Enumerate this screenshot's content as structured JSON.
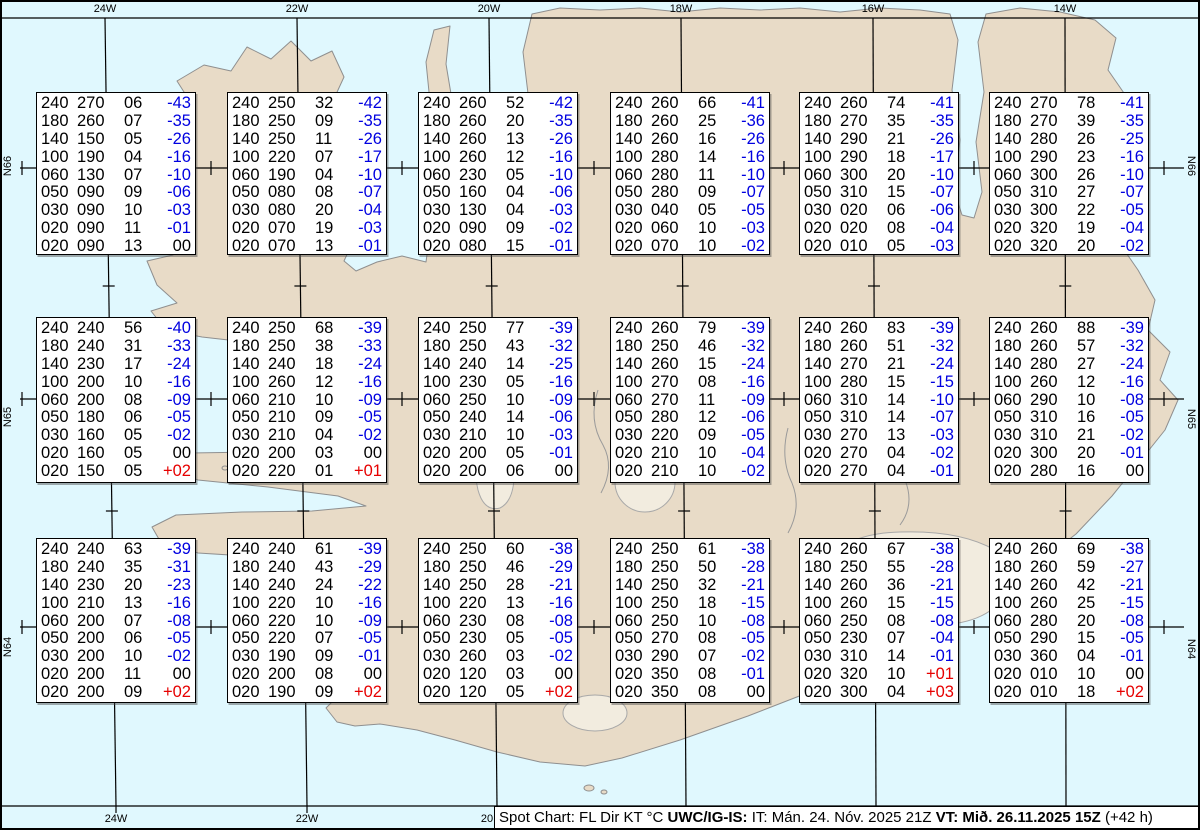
{
  "colors": {
    "water": "#e0f8fe",
    "land": "#e8dbc7",
    "coastline": "#8f8f8f",
    "temp_negative": "#0000e0",
    "temp_positive": "#e60000",
    "table_background": "#ffffff",
    "graticule": "#000000"
  },
  "graticule": {
    "top_labels": [
      "24W",
      "22W",
      "20W",
      "18W",
      "16W",
      "14W"
    ],
    "bottom_labels": [
      "24W",
      "22W",
      "20"
    ],
    "left_labels": [
      "N66",
      "N65",
      "N64"
    ],
    "right_labels": [
      "N66",
      "N65",
      "N64"
    ]
  },
  "boxes": [
    {
      "rows": [
        [
          "240",
          "270",
          "06",
          "-43"
        ],
        [
          "180",
          "260",
          "07",
          "-35"
        ],
        [
          "140",
          "150",
          "05",
          "-26"
        ],
        [
          "100",
          "190",
          "04",
          "-16"
        ],
        [
          "060",
          "130",
          "07",
          "-10"
        ],
        [
          "050",
          "090",
          "09",
          "-06"
        ],
        [
          "030",
          "090",
          "10",
          "-03"
        ],
        [
          "020",
          "090",
          "11",
          "-01"
        ],
        [
          "020",
          "090",
          "13",
          "00"
        ]
      ]
    },
    {
      "rows": [
        [
          "240",
          "250",
          "32",
          "-42"
        ],
        [
          "180",
          "250",
          "09",
          "-35"
        ],
        [
          "140",
          "250",
          "11",
          "-26"
        ],
        [
          "100",
          "220",
          "07",
          "-17"
        ],
        [
          "060",
          "190",
          "04",
          "-10"
        ],
        [
          "050",
          "080",
          "08",
          "-07"
        ],
        [
          "030",
          "080",
          "20",
          "-04"
        ],
        [
          "020",
          "070",
          "19",
          "-03"
        ],
        [
          "020",
          "070",
          "13",
          "-01"
        ]
      ]
    },
    {
      "rows": [
        [
          "240",
          "260",
          "52",
          "-42"
        ],
        [
          "180",
          "260",
          "20",
          "-35"
        ],
        [
          "140",
          "260",
          "13",
          "-26"
        ],
        [
          "100",
          "260",
          "12",
          "-16"
        ],
        [
          "060",
          "230",
          "05",
          "-10"
        ],
        [
          "050",
          "160",
          "04",
          "-06"
        ],
        [
          "030",
          "130",
          "04",
          "-03"
        ],
        [
          "020",
          "090",
          "09",
          "-02"
        ],
        [
          "020",
          "080",
          "15",
          "-01"
        ]
      ]
    },
    {
      "rows": [
        [
          "240",
          "260",
          "66",
          "-41"
        ],
        [
          "180",
          "260",
          "25",
          "-36"
        ],
        [
          "140",
          "260",
          "16",
          "-26"
        ],
        [
          "100",
          "280",
          "14",
          "-16"
        ],
        [
          "060",
          "280",
          "11",
          "-10"
        ],
        [
          "050",
          "280",
          "09",
          "-07"
        ],
        [
          "030",
          "040",
          "05",
          "-05"
        ],
        [
          "020",
          "060",
          "10",
          "-03"
        ],
        [
          "020",
          "070",
          "10",
          "-02"
        ]
      ]
    },
    {
      "rows": [
        [
          "240",
          "260",
          "74",
          "-41"
        ],
        [
          "180",
          "270",
          "35",
          "-35"
        ],
        [
          "140",
          "290",
          "21",
          "-26"
        ],
        [
          "100",
          "290",
          "18",
          "-17"
        ],
        [
          "060",
          "300",
          "20",
          "-10"
        ],
        [
          "050",
          "310",
          "15",
          "-07"
        ],
        [
          "030",
          "020",
          "06",
          "-06"
        ],
        [
          "020",
          "020",
          "08",
          "-04"
        ],
        [
          "020",
          "010",
          "05",
          "-03"
        ]
      ]
    },
    {
      "rows": [
        [
          "240",
          "270",
          "78",
          "-41"
        ],
        [
          "180",
          "270",
          "39",
          "-35"
        ],
        [
          "140",
          "280",
          "26",
          "-25"
        ],
        [
          "100",
          "290",
          "23",
          "-16"
        ],
        [
          "060",
          "300",
          "26",
          "-10"
        ],
        [
          "050",
          "310",
          "27",
          "-07"
        ],
        [
          "030",
          "300",
          "22",
          "-05"
        ],
        [
          "020",
          "320",
          "19",
          "-04"
        ],
        [
          "020",
          "320",
          "20",
          "-02"
        ]
      ]
    },
    {
      "rows": [
        [
          "240",
          "240",
          "56",
          "-40"
        ],
        [
          "180",
          "240",
          "31",
          "-33"
        ],
        [
          "140",
          "230",
          "17",
          "-24"
        ],
        [
          "100",
          "200",
          "10",
          "-16"
        ],
        [
          "060",
          "200",
          "08",
          "-09"
        ],
        [
          "050",
          "180",
          "06",
          "-05"
        ],
        [
          "030",
          "160",
          "05",
          "-02"
        ],
        [
          "020",
          "160",
          "05",
          "00"
        ],
        [
          "020",
          "150",
          "05",
          "+02"
        ]
      ]
    },
    {
      "rows": [
        [
          "240",
          "250",
          "68",
          "-39"
        ],
        [
          "180",
          "250",
          "38",
          "-33"
        ],
        [
          "140",
          "240",
          "18",
          "-24"
        ],
        [
          "100",
          "260",
          "12",
          "-16"
        ],
        [
          "060",
          "210",
          "10",
          "-09"
        ],
        [
          "050",
          "210",
          "09",
          "-05"
        ],
        [
          "030",
          "210",
          "04",
          "-02"
        ],
        [
          "020",
          "200",
          "03",
          "00"
        ],
        [
          "020",
          "220",
          "01",
          "+01"
        ]
      ]
    },
    {
      "rows": [
        [
          "240",
          "250",
          "77",
          "-39"
        ],
        [
          "180",
          "250",
          "43",
          "-32"
        ],
        [
          "140",
          "240",
          "14",
          "-25"
        ],
        [
          "100",
          "230",
          "05",
          "-16"
        ],
        [
          "060",
          "250",
          "10",
          "-09"
        ],
        [
          "050",
          "240",
          "14",
          "-06"
        ],
        [
          "030",
          "210",
          "10",
          "-03"
        ],
        [
          "020",
          "200",
          "05",
          "-01"
        ],
        [
          "020",
          "200",
          "06",
          "00"
        ]
      ]
    },
    {
      "rows": [
        [
          "240",
          "260",
          "79",
          "-39"
        ],
        [
          "180",
          "250",
          "46",
          "-32"
        ],
        [
          "140",
          "260",
          "15",
          "-24"
        ],
        [
          "100",
          "270",
          "08",
          "-16"
        ],
        [
          "060",
          "270",
          "11",
          "-09"
        ],
        [
          "050",
          "280",
          "12",
          "-06"
        ],
        [
          "030",
          "220",
          "09",
          "-05"
        ],
        [
          "020",
          "210",
          "10",
          "-04"
        ],
        [
          "020",
          "210",
          "10",
          "-02"
        ]
      ]
    },
    {
      "rows": [
        [
          "240",
          "260",
          "83",
          "-39"
        ],
        [
          "180",
          "260",
          "51",
          "-32"
        ],
        [
          "140",
          "270",
          "21",
          "-24"
        ],
        [
          "100",
          "280",
          "15",
          "-15"
        ],
        [
          "060",
          "310",
          "14",
          "-10"
        ],
        [
          "050",
          "310",
          "14",
          "-07"
        ],
        [
          "030",
          "270",
          "13",
          "-03"
        ],
        [
          "020",
          "270",
          "04",
          "-02"
        ],
        [
          "020",
          "270",
          "04",
          "-01"
        ]
      ]
    },
    {
      "rows": [
        [
          "240",
          "260",
          "88",
          "-39"
        ],
        [
          "180",
          "260",
          "57",
          "-32"
        ],
        [
          "140",
          "280",
          "27",
          "-24"
        ],
        [
          "100",
          "260",
          "12",
          "-16"
        ],
        [
          "060",
          "290",
          "10",
          "-08"
        ],
        [
          "050",
          "310",
          "16",
          "-05"
        ],
        [
          "030",
          "310",
          "21",
          "-02"
        ],
        [
          "020",
          "300",
          "20",
          "-01"
        ],
        [
          "020",
          "280",
          "16",
          "00"
        ]
      ]
    },
    {
      "rows": [
        [
          "240",
          "240",
          "63",
          "-39"
        ],
        [
          "180",
          "240",
          "35",
          "-31"
        ],
        [
          "140",
          "230",
          "20",
          "-23"
        ],
        [
          "100",
          "210",
          "13",
          "-16"
        ],
        [
          "060",
          "200",
          "07",
          "-08"
        ],
        [
          "050",
          "200",
          "06",
          "-05"
        ],
        [
          "030",
          "200",
          "10",
          "-02"
        ],
        [
          "020",
          "200",
          "11",
          "00"
        ],
        [
          "020",
          "200",
          "09",
          "+02"
        ]
      ]
    },
    {
      "rows": [
        [
          "240",
          "240",
          "61",
          "-39"
        ],
        [
          "180",
          "240",
          "43",
          "-29"
        ],
        [
          "140",
          "240",
          "24",
          "-22"
        ],
        [
          "100",
          "220",
          "10",
          "-16"
        ],
        [
          "060",
          "220",
          "10",
          "-09"
        ],
        [
          "050",
          "220",
          "07",
          "-05"
        ],
        [
          "030",
          "190",
          "09",
          "-01"
        ],
        [
          "020",
          "200",
          "08",
          "00"
        ],
        [
          "020",
          "190",
          "09",
          "+02"
        ]
      ]
    },
    {
      "rows": [
        [
          "240",
          "250",
          "60",
          "-38"
        ],
        [
          "180",
          "250",
          "46",
          "-29"
        ],
        [
          "140",
          "250",
          "28",
          "-21"
        ],
        [
          "100",
          "220",
          "13",
          "-16"
        ],
        [
          "060",
          "230",
          "08",
          "-08"
        ],
        [
          "050",
          "230",
          "05",
          "-05"
        ],
        [
          "030",
          "260",
          "03",
          "-02"
        ],
        [
          "020",
          "120",
          "03",
          "00"
        ],
        [
          "020",
          "120",
          "05",
          "+02"
        ]
      ]
    },
    {
      "rows": [
        [
          "240",
          "250",
          "61",
          "-38"
        ],
        [
          "180",
          "250",
          "50",
          "-28"
        ],
        [
          "140",
          "250",
          "32",
          "-21"
        ],
        [
          "100",
          "250",
          "18",
          "-15"
        ],
        [
          "060",
          "250",
          "10",
          "-08"
        ],
        [
          "050",
          "270",
          "08",
          "-05"
        ],
        [
          "030",
          "290",
          "07",
          "-02"
        ],
        [
          "020",
          "350",
          "08",
          "-01"
        ],
        [
          "020",
          "350",
          "08",
          "00"
        ]
      ]
    },
    {
      "rows": [
        [
          "240",
          "260",
          "67",
          "-38"
        ],
        [
          "180",
          "250",
          "55",
          "-28"
        ],
        [
          "140",
          "260",
          "36",
          "-21"
        ],
        [
          "100",
          "260",
          "15",
          "-15"
        ],
        [
          "060",
          "250",
          "08",
          "-08"
        ],
        [
          "050",
          "230",
          "07",
          "-04"
        ],
        [
          "030",
          "310",
          "14",
          "-01"
        ],
        [
          "020",
          "320",
          "10",
          "+01"
        ],
        [
          "020",
          "300",
          "04",
          "+03"
        ]
      ]
    },
    {
      "rows": [
        [
          "240",
          "260",
          "69",
          "-38"
        ],
        [
          "180",
          "260",
          "59",
          "-27"
        ],
        [
          "140",
          "260",
          "42",
          "-21"
        ],
        [
          "100",
          "260",
          "25",
          "-15"
        ],
        [
          "060",
          "280",
          "20",
          "-08"
        ],
        [
          "050",
          "290",
          "15",
          "-05"
        ],
        [
          "030",
          "360",
          "04",
          "-01"
        ],
        [
          "020",
          "010",
          "10",
          "00"
        ],
        [
          "020",
          "010",
          "18",
          "+02"
        ]
      ]
    }
  ],
  "footer": {
    "segments": [
      {
        "text": "Spot Chart: FL Dir KT °C ",
        "bold": false
      },
      {
        "text": "UWC/IG-IS:",
        "bold": true
      },
      {
        "text": " IT: Mán. 24. Nóv. 2025 21Z ",
        "bold": false
      },
      {
        "text": "VT: Mið. 26.11.2025 15Z",
        "bold": true
      },
      {
        "text": " (+42 h)",
        "bold": false
      }
    ]
  }
}
